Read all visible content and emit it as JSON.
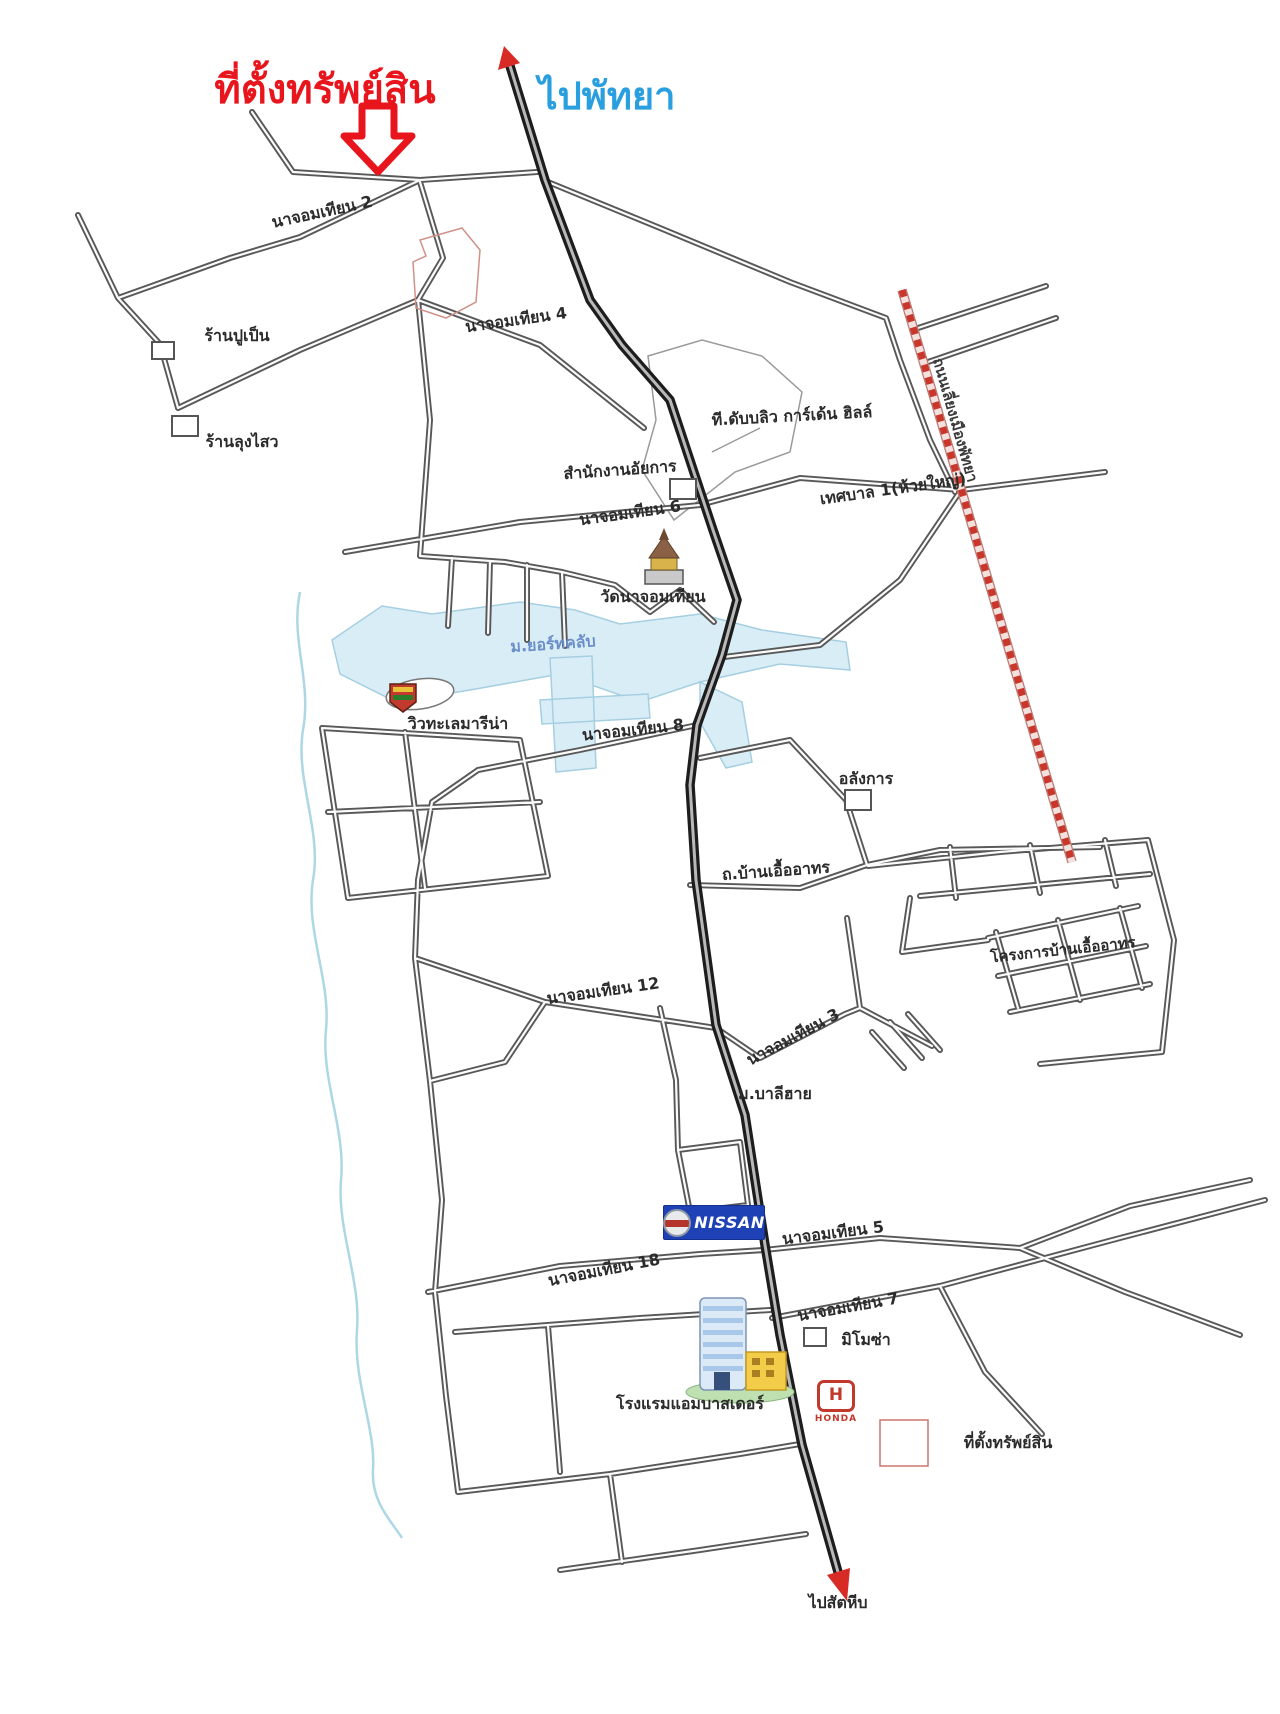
{
  "canvas": {
    "width": 1280,
    "height": 1714
  },
  "colors": {
    "title_red": "#e8151c",
    "pattaya_blue": "#2a9fe0",
    "road_gray": "#585858",
    "highway_black": "#1d1d1d",
    "railway_red": "#c9372c",
    "water_blue": "#d9edf6",
    "property_hatch_pink": "#e08a80",
    "nissan_blue": "#1e42b5",
    "honda_red": "#c0392b"
  },
  "labels": {
    "title": "ที่ตั้งทรัพย์สิน",
    "to_pattaya": "ไปพัทยา",
    "to_sattahip": "ไปสัตหีบ",
    "najomtien2": "นาจอมเทียน 2",
    "najomtien4": "นาจอมเทียน 4",
    "najomtien6": "นาจอมเทียน 6",
    "najomtien8": "นาจอมเทียน 8",
    "najomtien12": "นาจอมเทียน 12",
    "najomtien3": "นาจอมเทียน 3",
    "najomtien5": "นาจอมเทียน 5",
    "najomtien18": "นาจอมเทียน 18",
    "najomtien7": "นาจอมเทียน 7",
    "ran_pu_pen": "ร้านปูเป็น",
    "ran_lung_sawai": "ร้านลุงไสว",
    "attorney_office": "สำนักงานอัยการ",
    "tw_garden_hill": "ที.ดับบลิว การ์เด้น ฮิลล์",
    "tesaban1": "เทศบาล 1(ห้วยใหญ่)",
    "bypass_road": "ถนนเลี่ยงเมืองพัทยา",
    "wat_najomtien": "วัดนาจอมเทียน",
    "yacht_club": "ม.ยอร์ทคลับ",
    "view_talay_marina": "วิวทะเลมารีน่า",
    "alangkarn": "อลังการ",
    "baan_uea_athon_rd": "ถ.บ้านเอื้ออาทร",
    "baan_uea_athon_project": "โครงการบ้านเอื้ออาทร",
    "balihai": "ม.บาลีฮาย",
    "mimosa": "มิโมซ่า",
    "ambassador_hotel": "โรงแรมแอมบาสเดอร์",
    "legend_property": "ที่ตั้งทรัพย์สิน"
  },
  "logos": {
    "nissan": "NISSAN",
    "honda_letter": "H",
    "honda_text": "HONDA"
  }
}
